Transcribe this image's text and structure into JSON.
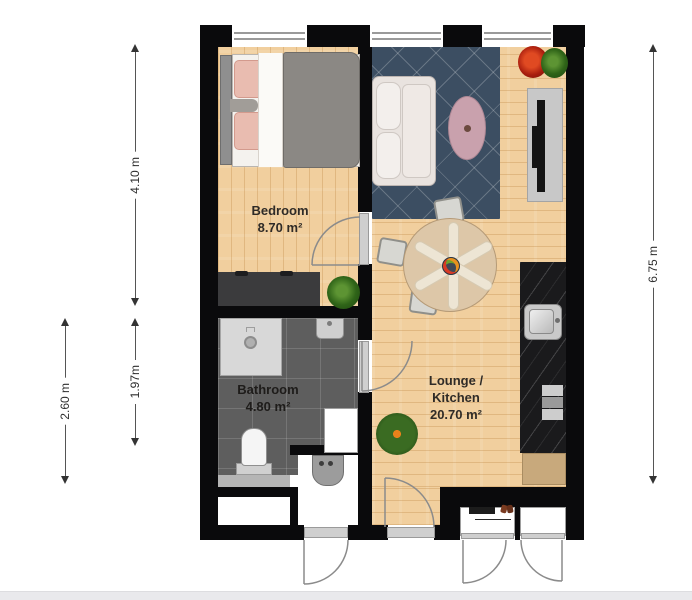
{
  "rooms": {
    "bedroom": {
      "name": "Bedroom",
      "area": "8.70 m²"
    },
    "bathroom": {
      "name": "Bathroom",
      "area": "4.80 m²"
    },
    "lounge_kitchen": {
      "name_line1": "Lounge /",
      "name_line2": "Kitchen",
      "area": "20.70 m²"
    }
  },
  "dimensions": {
    "bedroom_height": "4.10 m",
    "bathroom_outer_height": "2.60 m",
    "bathroom_inner_height": "1.97m",
    "total_height": "6.75 m"
  },
  "furniture": [
    "double-bed",
    "wardrobe",
    "area-rug",
    "sofa",
    "pouf",
    "tv-stand",
    "dining-table",
    "dining-chair",
    "kitchen-counter",
    "kitchen-sink",
    "stove",
    "kitchen-cabinet",
    "shower",
    "bathroom-sink",
    "toilet",
    "bathroom-cabinet",
    "washing-machine",
    "plant",
    "coat-rack",
    "shoes"
  ],
  "colors": {
    "wall": "#0a0a0c",
    "wood_floor": "#f1cf9e",
    "bathroom_tile": "#5e5e5e",
    "rug": "#3c4e62",
    "kitchen_counter": "#1a1a1c",
    "pouf": "#c9a1ad",
    "plant": "#2f6418"
  }
}
